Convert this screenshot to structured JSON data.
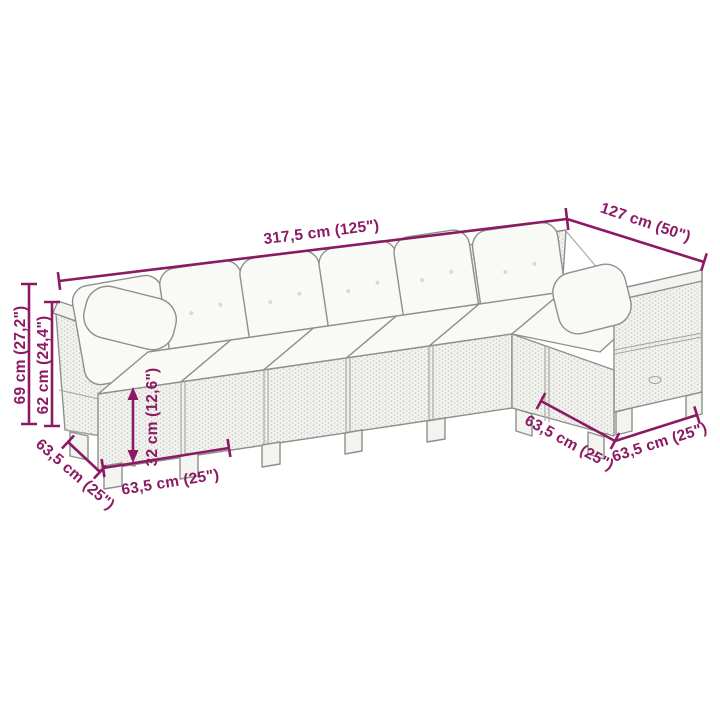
{
  "diagram": {
    "type": "product-dimension-diagram",
    "subject": "L-shaped poly rattan sectional garden sofa with cushions",
    "background_color": "#ffffff",
    "annotation_color": "#8b1a62",
    "sofa_line_color": "#8f8f8d",
    "wicker_fill_color": "#f2f2ef",
    "cushion_fill_color": "#f9f9f6"
  },
  "dims": {
    "total_length": {
      "label": "317,5 cm (125\")",
      "cm": "317,5",
      "inches": "125"
    },
    "right_depth": {
      "label": "127 cm (50\")",
      "cm": "127",
      "inches": "50"
    },
    "total_height": {
      "label": "69 cm (27,2\")",
      "cm": "69",
      "inches": "27,2"
    },
    "arm_height": {
      "label": "62 cm (24,4\")",
      "cm": "62",
      "inches": "24,4"
    },
    "seat_height": {
      "label": "32 cm (12,6\")",
      "cm": "32",
      "inches": "12,6"
    },
    "left_depth": {
      "label": "63,5 cm (25\")",
      "cm": "63,5",
      "inches": "25"
    },
    "seat_width": {
      "label": "63,5 cm (25\")",
      "cm": "63,5",
      "inches": "25"
    },
    "corner_depth_left": {
      "label": "63,5 cm (25\")",
      "cm": "63,5",
      "inches": "25"
    },
    "corner_depth_right": {
      "label": "63,5 cm (25\")",
      "cm": "63,5",
      "inches": "25"
    }
  }
}
